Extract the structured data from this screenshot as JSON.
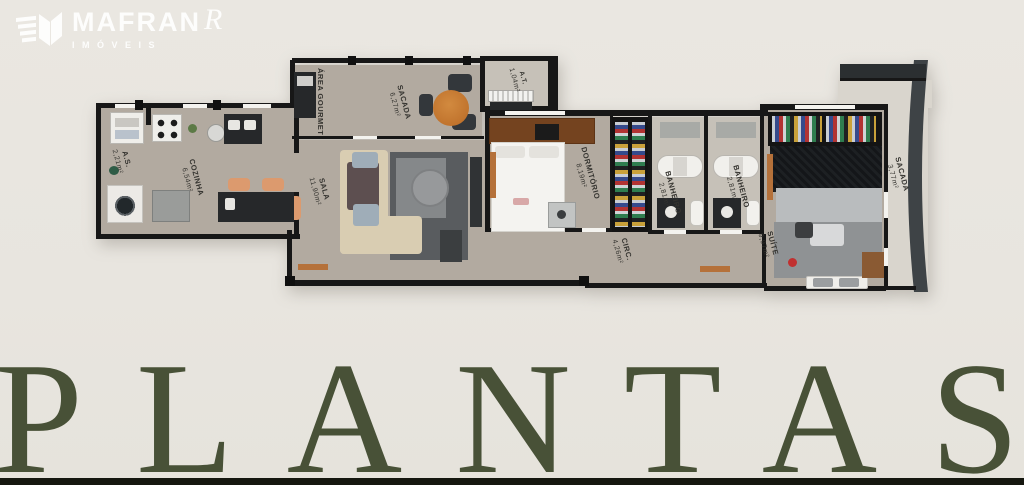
{
  "logo": {
    "brand": "MAFRAN",
    "brand_suffix": "R",
    "tagline": "IMÓVEIS"
  },
  "title": {
    "text": "PLANTAS"
  },
  "floorplan": {
    "rooms": [
      {
        "label": "A.S.",
        "area": "2,21m²"
      },
      {
        "label": "COZINHA",
        "area": "6,54m²"
      },
      {
        "label": "ÁREA GOURMET",
        "area": ""
      },
      {
        "label": "SACADA",
        "area": "6,27m²"
      },
      {
        "label": "SALA",
        "area": "11,90m²"
      },
      {
        "label": "A.T.",
        "area": "1,04m²"
      },
      {
        "label": "DORMITÓRIO",
        "area": "8,19m²"
      },
      {
        "label": "CIRC.",
        "area": "4,26m²"
      },
      {
        "label": "BANHEIRO",
        "area": "2,81m²"
      },
      {
        "label": "BANHEIRO",
        "area": "2,81m²"
      },
      {
        "label": "SUÍTE",
        "area": "9,97m²"
      },
      {
        "label": "SACADA",
        "area": "3,77m²"
      }
    ]
  },
  "colors": {
    "background": "#e9e6e0",
    "wall": "#171717",
    "floor": "#b2aaa0",
    "accent_wood": "#b5713a",
    "title_green": "#485137",
    "bottom_bar": "#15170f",
    "logo_white": "#ffffff"
  }
}
